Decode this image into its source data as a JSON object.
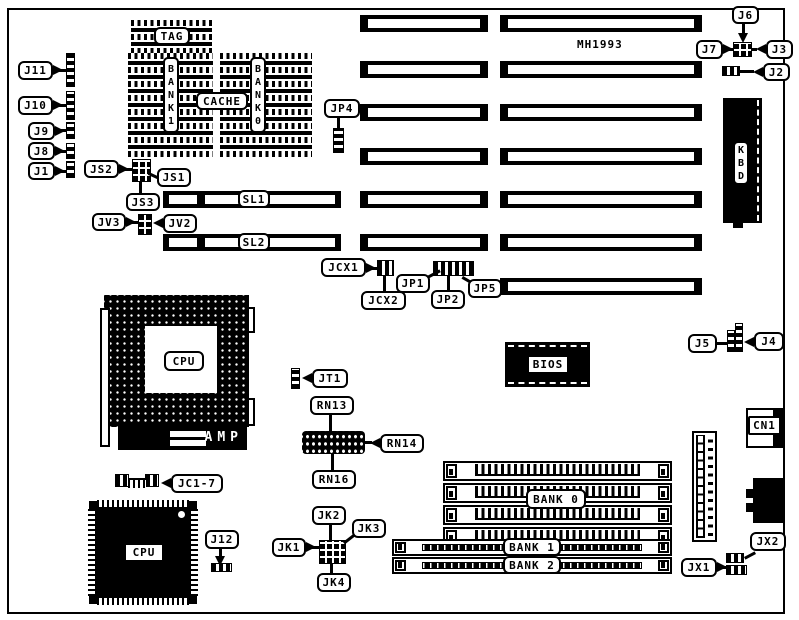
{
  "colors": {
    "ink": "#000000",
    "paper": "#ffffff"
  },
  "board": {
    "model": "MH1993",
    "cache": {
      "tag": "TAG",
      "label": "CACHE",
      "bank1_vertical": "B\nA\nN\nK\n1",
      "bank0_vertical": "B\nA\nN\nK\n0"
    },
    "slots": {
      "sl1": "SL1",
      "sl2": "SL2"
    },
    "memory_banks": {
      "bank0": "BANK 0",
      "bank1": "BANK 1",
      "bank2": "BANK 2"
    },
    "chips": {
      "cpu_socket": "CPU",
      "cpu_chip": "CPU",
      "bios": "BIOS",
      "amp": "AMP",
      "kbd_vertical": "K\nB\nD"
    },
    "connectors": {
      "j11": "J11",
      "j10": "J10",
      "j9": "J9",
      "j8": "J8",
      "j1": "J1",
      "j2": "J2",
      "j3": "J3",
      "j6": "J6",
      "j7": "J7",
      "j5": "J5",
      "j4": "J4",
      "jp4": "JP4",
      "jt1": "JT1",
      "jc17": "JC1-7",
      "j12": "J12",
      "cn1": "CN1",
      "jx1": "JX1",
      "jx2": "JX2"
    },
    "jumpers": {
      "js1": "JS1",
      "js2": "JS2",
      "js3": "JS3",
      "jv2": "JV2",
      "jv3": "JV3",
      "jcx1": "JCX1",
      "jcx2": "JCX2",
      "jp1": "JP1",
      "jp2": "JP2",
      "jp5": "JP5",
      "jk1": "JK1",
      "jk2": "JK2",
      "jk3": "JK3",
      "jk4": "JK4"
    },
    "resistor_networks": {
      "rn13": "RN13",
      "rn14": "RN14",
      "rn16": "RN16"
    }
  }
}
